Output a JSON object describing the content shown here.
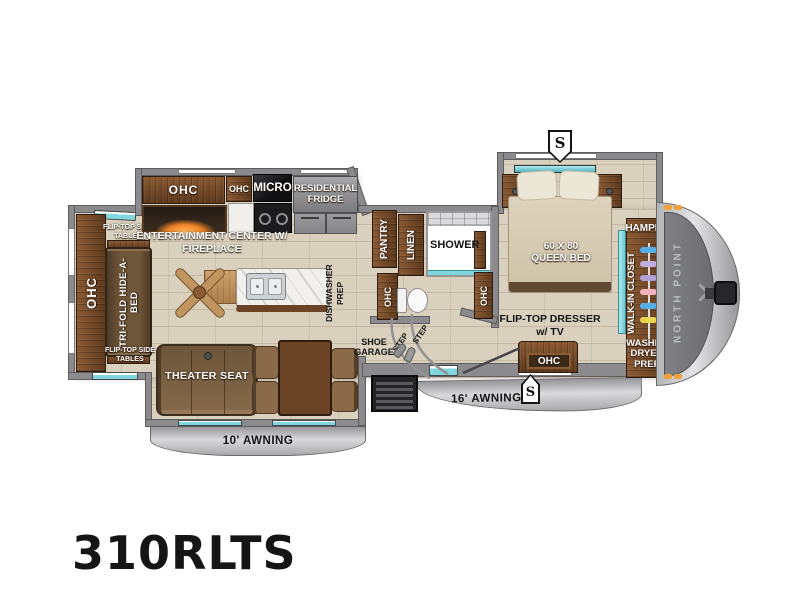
{
  "title": {
    "model": "310RLTS"
  },
  "badges": {
    "slide": "S"
  },
  "front_cap": {
    "brand": "NORTH POINT"
  },
  "rear": {
    "ohc": "OHC",
    "sofa": "TRI-FOLD HIDE-A-BED",
    "flip_top_tables_top": "FLIP-TOP SIDE TABLES",
    "flip_top_tables_bottom": "FLIP-TOP SIDE TABLES"
  },
  "kitchen": {
    "ohc_long": "OHC",
    "ohc_small": "OHC",
    "micro": "MICRO",
    "fridge": "RESIDENTIAL FRIDGE",
    "entertainment_center": "ENTERTAINMENT CENTER W/ FIREPLACE",
    "dishwasher_prep": "DISHWASHER\nPREP"
  },
  "bath": {
    "pantry": "PANTRY",
    "linen": "LINEN",
    "shower": "SHOWER",
    "ohc_hall": "OHC",
    "ohc_shower": "OHC"
  },
  "bedroom": {
    "bed": "60 X 80 QUEEN BED",
    "dresser": "FLIP-TOP DRESSER w/ TV",
    "dresser_ohc": "OHC"
  },
  "closet": {
    "hamper": "HAMPER",
    "walk_in": "WALK-IN CLOSET",
    "washer_dryer_prep": "WASHER DRYER PREP"
  },
  "living_slide": {
    "theater_seat": "THEATER SEAT",
    "awning": "10' AWNING"
  },
  "entry": {
    "shoe_garage": "SHOE GARAGE",
    "step_upper": "STEP",
    "step_lower": "STEP",
    "awning": "16' AWNING"
  },
  "colors": {
    "teal_accent": "#7fd6de",
    "wall_gray": "#8b8b8d",
    "wood_brown": "#6f4527",
    "marker_light_orange": "#f0a13a",
    "fireplace_glow": "#f08030"
  }
}
